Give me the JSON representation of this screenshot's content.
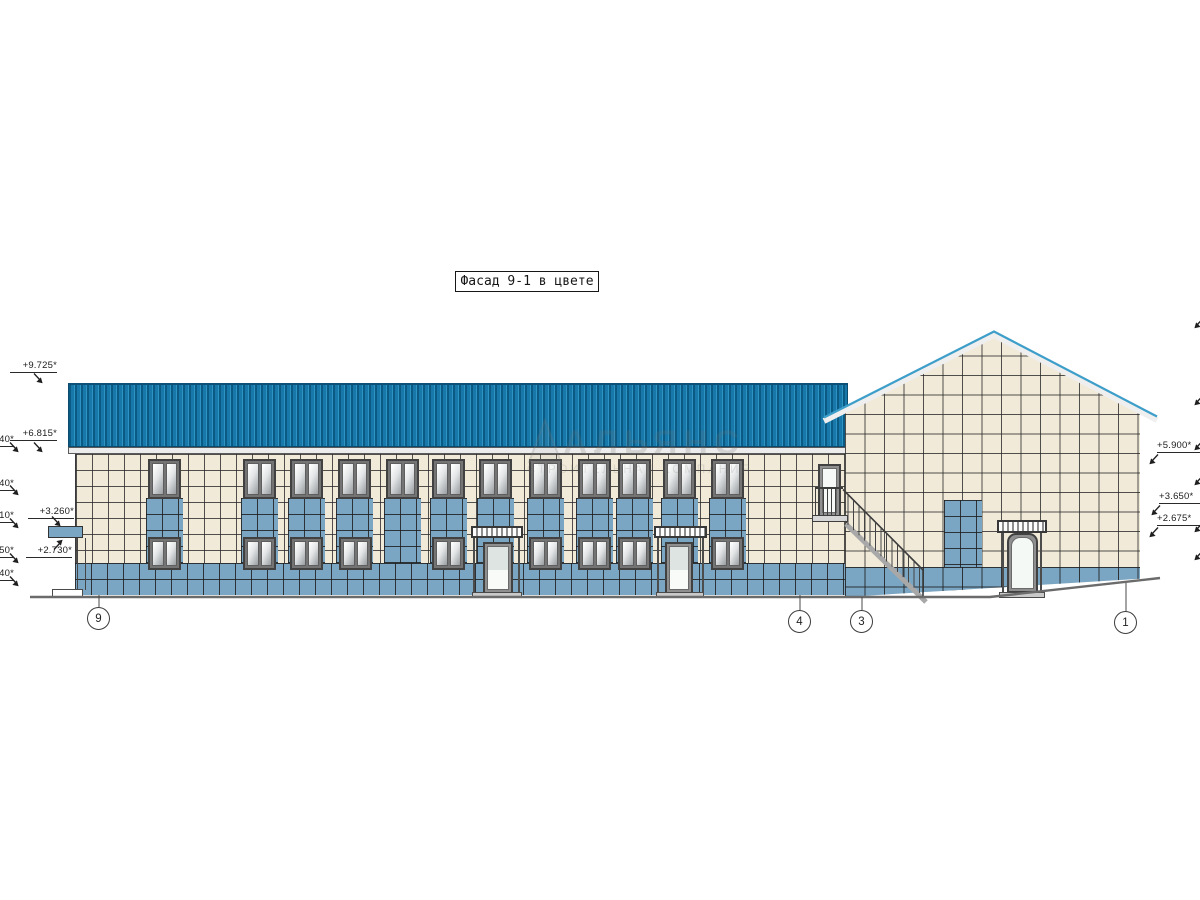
{
  "drawing": {
    "title": "Фасад 9-1 в цвете",
    "type": "facade-elevation"
  },
  "elevation_marks": {
    "left": [
      "+9.725*",
      "+6.815*",
      "+3.260*",
      "+2.730*"
    ],
    "left_clipped": [
      "40*",
      "40*",
      "10*",
      "50*",
      "40*"
    ],
    "right": [
      "+5.900*",
      "+3.650*",
      "+2.675*"
    ]
  },
  "axis_bubbles": [
    "9",
    "4",
    "3",
    "1"
  ],
  "watermark": {
    "line1": "АЛЬЯНС",
    "line2": "СТРОИТЕЛЬНАЯ КОМПАНИЯ"
  },
  "colors": {
    "roof_blue": "#1878aa",
    "roof_blue_dark": "#0b5a83",
    "tile_cream": "#f1ead8",
    "tile_blue": "#7aa6c4",
    "fascia_blue": "#3d9ec9",
    "line_dark": "#2d2d2d"
  }
}
